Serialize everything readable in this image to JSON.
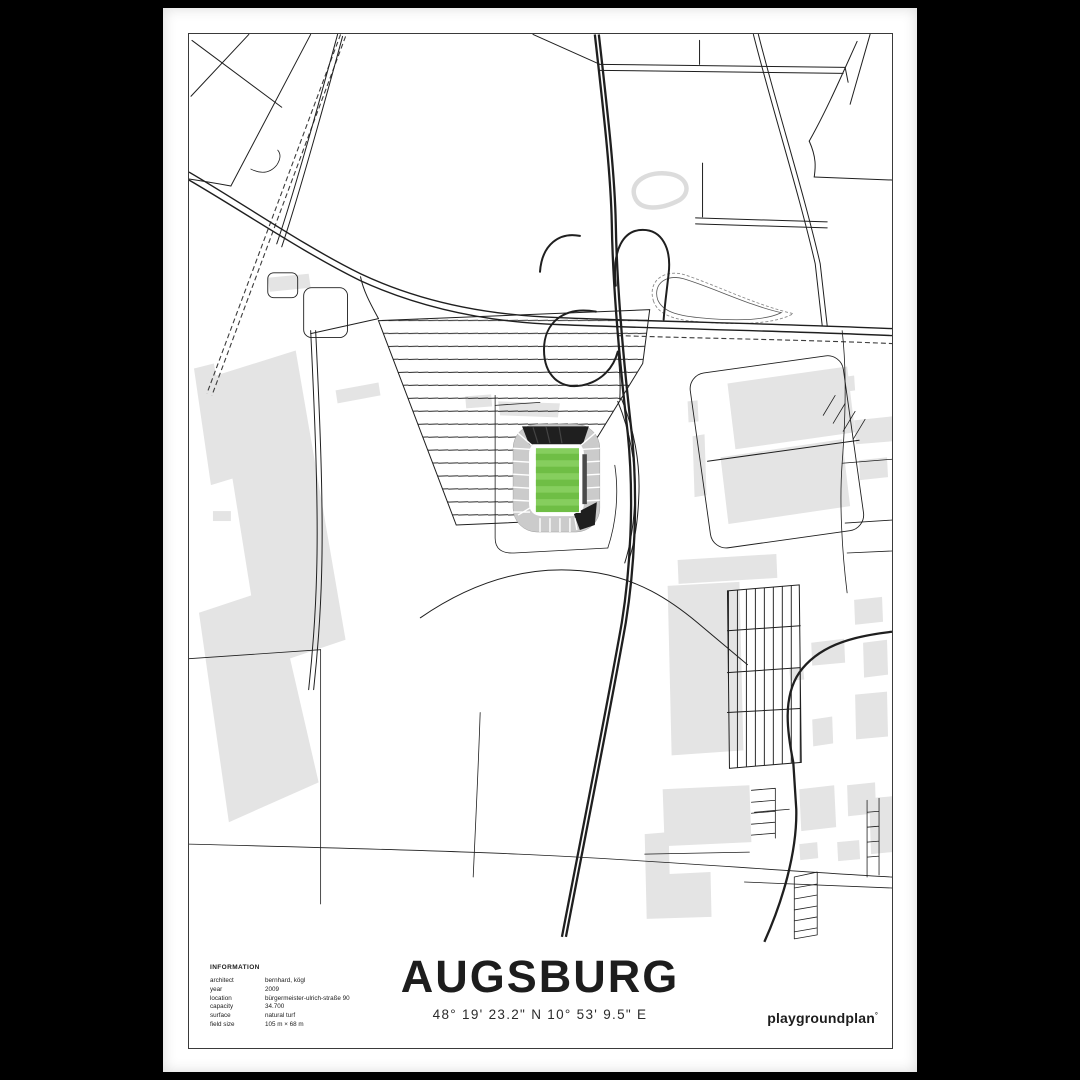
{
  "poster": {
    "title": "AUGSBURG",
    "coordinates": "48° 19' 23.2\" N  10° 53' 9.5\" E",
    "brand": {
      "name": "playgroundplan",
      "mark": "°"
    },
    "information": {
      "heading": "INFORMATION",
      "rows": [
        {
          "label": "architect",
          "value": "bernhard, kögl"
        },
        {
          "label": "year",
          "value": "2009"
        },
        {
          "label": "location",
          "value": "bürgermeister-ulrich-straße 90"
        },
        {
          "label": "capacity",
          "value": "34.700"
        },
        {
          "label": "surface",
          "value": "natural turf"
        },
        {
          "label": "field size",
          "value": "105 m × 68 m"
        }
      ]
    },
    "map": {
      "subject": "street map around the Augsburg stadium with green football pitch",
      "legend": {
        "roads": "black lines",
        "railway": "dashed line",
        "buildings": "light gray shapes",
        "stadium_pitch": "green striped rectangle"
      }
    },
    "theme": {
      "background": "#000000",
      "paper": "#ffffff",
      "line": "#1f1f1f",
      "building": "#e4e4e4",
      "pitch_green_light": "#86ce5e",
      "pitch_green_dark": "#6fbe45",
      "stand_gray": "#cbcbcb",
      "stand_dark": "#1f1f1f"
    }
  }
}
